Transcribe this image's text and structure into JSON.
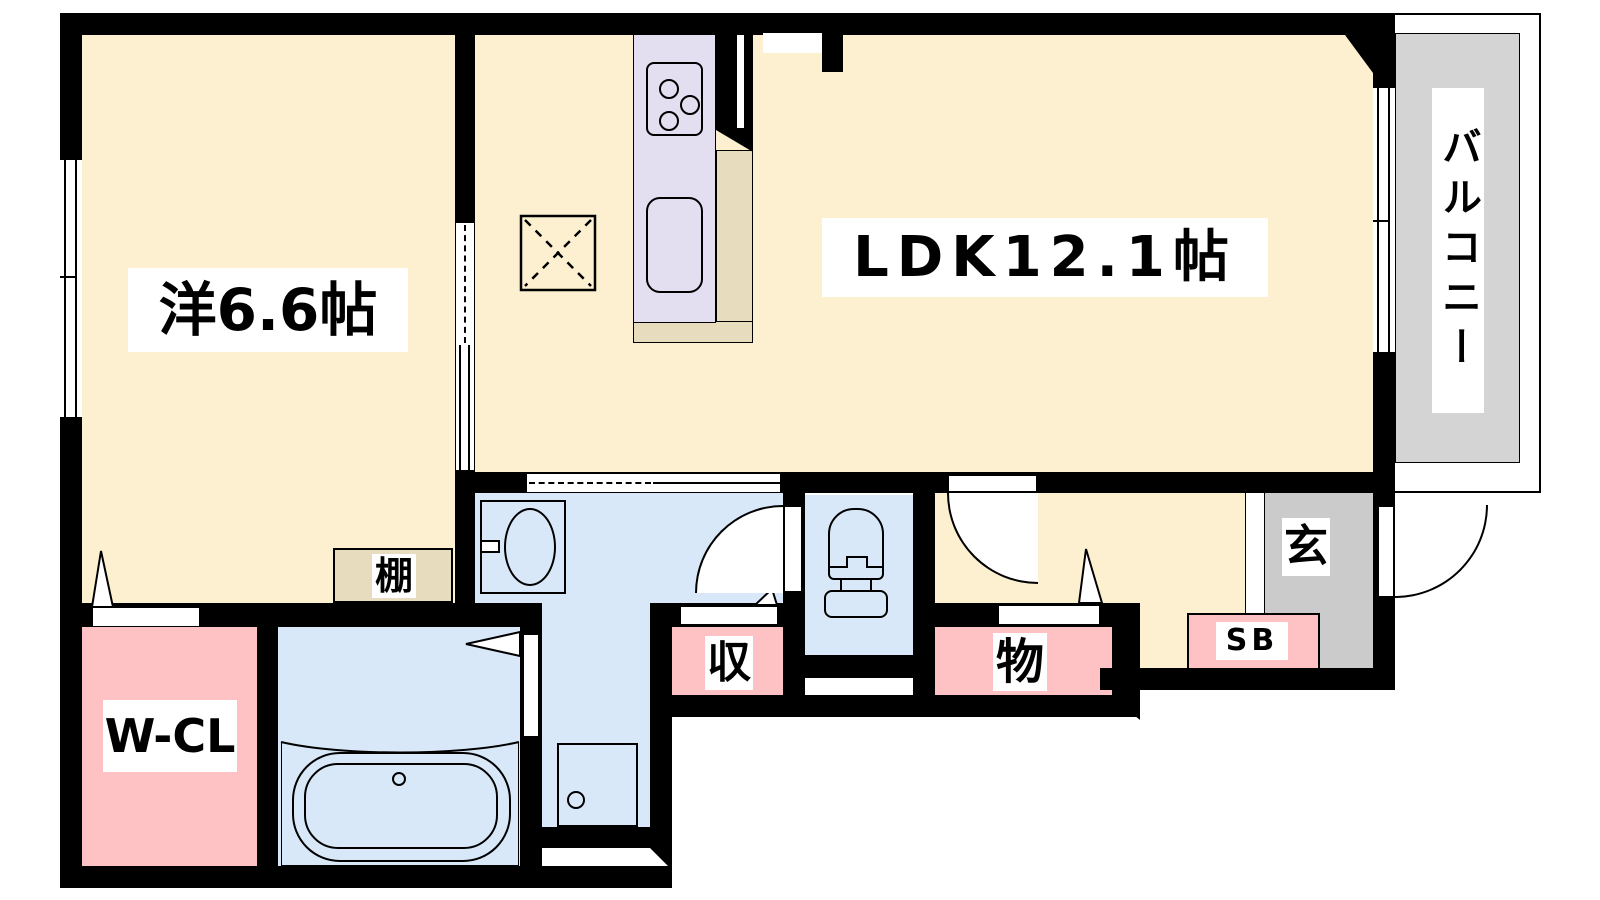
{
  "floorplan": {
    "rooms": {
      "western_room": "洋6.6帖",
      "ldk": "LDK12.1帖",
      "balcony": "バルコニー",
      "walk_in_closet": "W-CL",
      "shelf": "棚",
      "closet": "収",
      "storage": "物",
      "entrance": "玄",
      "shoe_box": "SB"
    },
    "colors": {
      "room_floor": "#FCF0D0",
      "wet_area_floor": "#D9E8F9",
      "storage_pink": "#FFC2C4",
      "kitchen_counter_unit": "#E4DEF1",
      "counter_top": "#E8DCBE",
      "balcony_gray": "#D4D4D4",
      "entrance_gray": "#CBCBCB",
      "wall": "#000000"
    },
    "fixtures": [
      "kitchen-stove",
      "kitchen-sink",
      "floor-hatch",
      "washbasin",
      "toilet",
      "bathtub",
      "washing-machine-pan"
    ]
  }
}
